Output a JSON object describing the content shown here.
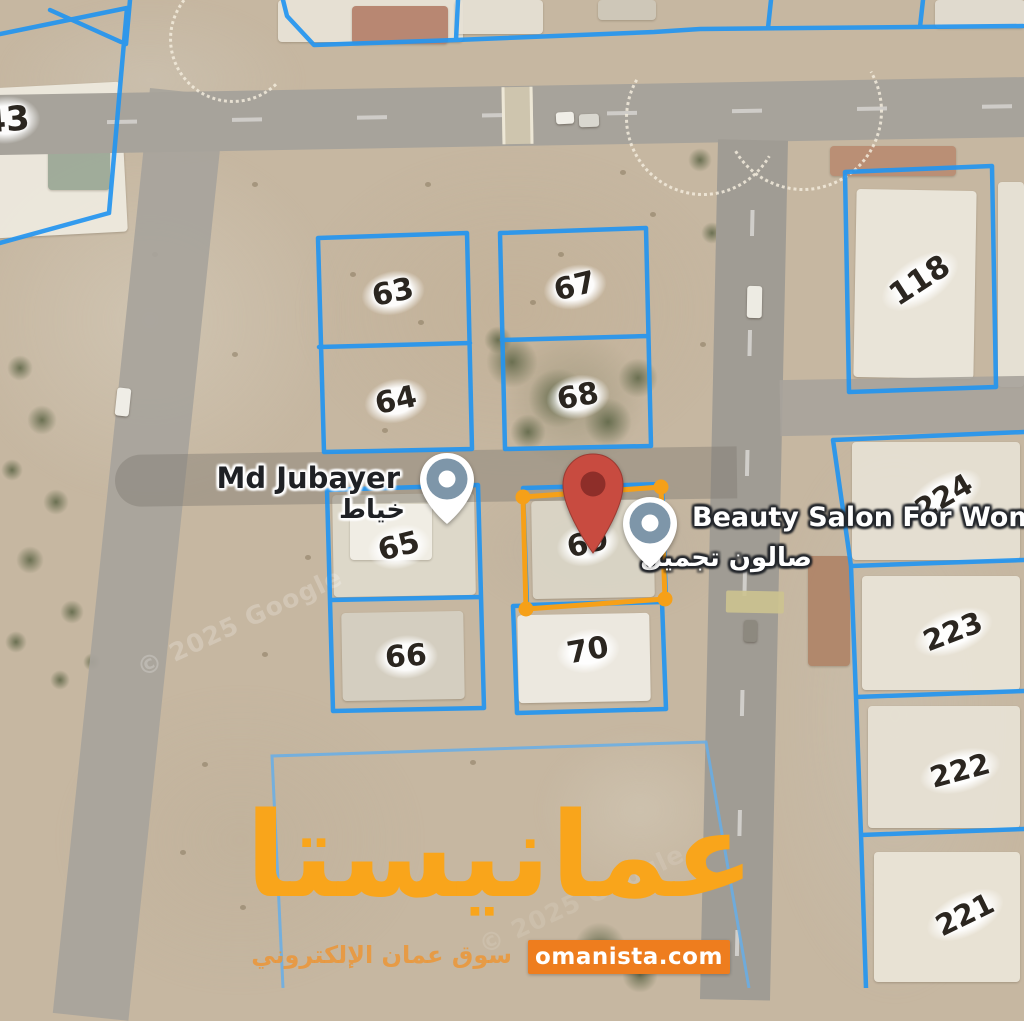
{
  "map": {
    "attribution": "© 2025 Google",
    "selected_plot_number": "69",
    "plots": [
      {
        "number": "43",
        "x": 6,
        "y": 120,
        "rot": -4,
        "size": 34
      },
      {
        "number": "63",
        "x": 393,
        "y": 293,
        "rot": -12,
        "size": 30
      },
      {
        "number": "64",
        "x": 396,
        "y": 401,
        "rot": -12,
        "size": 30
      },
      {
        "number": "67",
        "x": 575,
        "y": 287,
        "rot": -14,
        "size": 30
      },
      {
        "number": "68",
        "x": 578,
        "y": 397,
        "rot": -10,
        "size": 30
      },
      {
        "number": "65",
        "x": 399,
        "y": 547,
        "rot": -14,
        "size": 30
      },
      {
        "number": "66",
        "x": 406,
        "y": 657,
        "rot": -4,
        "size": 30
      },
      {
        "number": "69",
        "x": 588,
        "y": 544,
        "rot": -14,
        "size": 30
      },
      {
        "number": "70",
        "x": 588,
        "y": 651,
        "rot": -10,
        "size": 30
      },
      {
        "number": "118",
        "x": 920,
        "y": 281,
        "rot": -33,
        "size": 31
      },
      {
        "number": "224",
        "x": 944,
        "y": 497,
        "rot": -30,
        "size": 29
      },
      {
        "number": "223",
        "x": 953,
        "y": 632,
        "rot": -21,
        "size": 29
      },
      {
        "number": "222",
        "x": 960,
        "y": 771,
        "rot": -15,
        "size": 29
      },
      {
        "number": "221",
        "x": 965,
        "y": 915,
        "rot": -26,
        "size": 29
      }
    ],
    "pois": [
      {
        "name": "Md Jubayer",
        "name_ar": "خياط"
      },
      {
        "name": "Beauty Salon For Women",
        "name_ar": "صالون تجميل"
      }
    ]
  },
  "watermark": {
    "brand_ar": "عمانيستا",
    "tagline_ar": "سوق عمان الإلكتروني",
    "domain": "omanista.com"
  },
  "colors": {
    "plot_line_blue": "#2395F0",
    "vacant_plot_blue": "#66AEE8",
    "selection_orange": "#F6A018",
    "pin_red": "#C84B40",
    "pin_red_dark": "#8E2E29",
    "poi_pin_gray_blue": "#7E96A9",
    "brand_orange": "#F9A51B",
    "badge_orange": "#EE7D1E",
    "sand": "#C6B7A1"
  }
}
